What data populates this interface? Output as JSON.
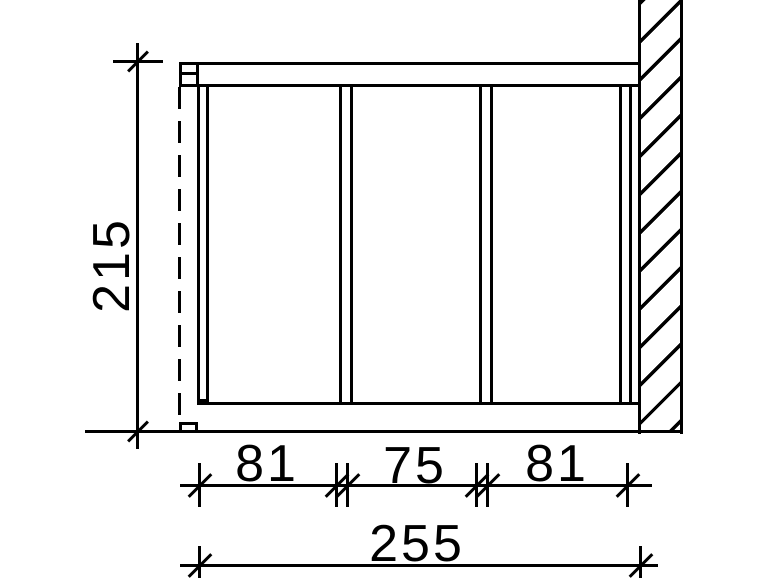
{
  "drawing": {
    "title": "side-wall elevation technical drawing",
    "colors": {
      "line": "#000000",
      "background": "#ffffff"
    },
    "dimensions": {
      "height": "215",
      "panel_widths": [
        "81",
        "75",
        "81"
      ],
      "total_width": "255"
    }
  }
}
